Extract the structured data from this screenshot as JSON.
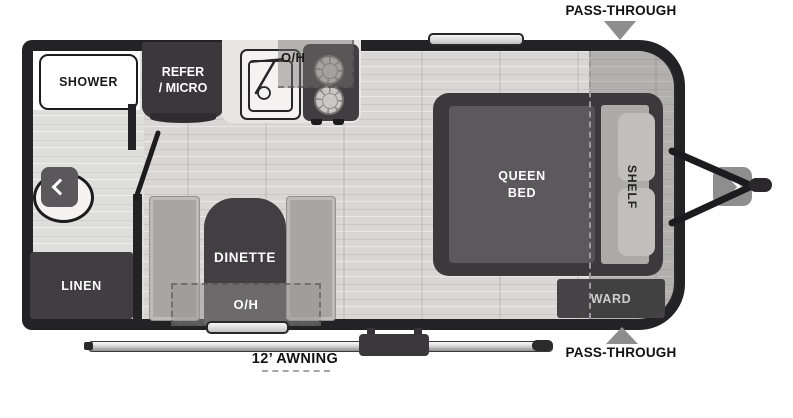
{
  "diagram_type": "travel-trailer-floorplan",
  "annotations": {
    "pass_through_top": "PASS-THROUGH",
    "pass_through_bottom": "PASS-THROUGH",
    "awning": "12’ AWNING"
  },
  "bathroom": {
    "shower": "SHOWER",
    "linen": "LINEN",
    "toilet_icon": "chevron-left"
  },
  "kitchen": {
    "refer_line1": "REFER",
    "refer_line2": "/ MICRO",
    "overhead": "O/H"
  },
  "dinette": {
    "label": "DINETTE",
    "overhead": "O/H"
  },
  "bedroom": {
    "bed_line1": "QUEEN",
    "bed_line2": "BED",
    "shelf": "SHELF",
    "ward": "WARD"
  },
  "exterior": {
    "hitch_icon": "chevron-right"
  },
  "colors": {
    "wall": "#232325",
    "dark_fixture": "#403e40",
    "mattress": "#5b595b",
    "bench": "#a8a6a4",
    "floor": "#d8d7d5",
    "arrow_gray": "#8d8d8d",
    "overlay": "rgba(60,58,60,0.25)"
  }
}
